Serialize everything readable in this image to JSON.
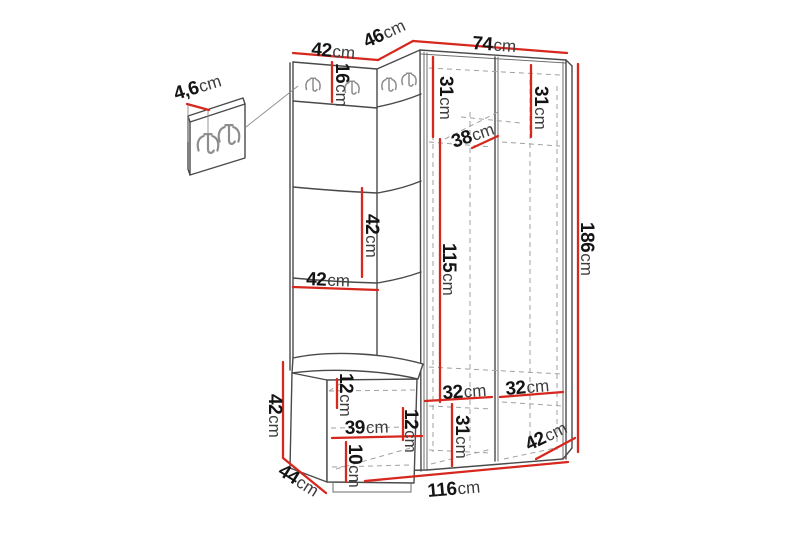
{
  "diagram": {
    "description": "Dimension diagram of a corner hallway furniture set: wall panel with coat hooks, corner section, two-door wardrobe and seat bench, plus a detail view of the hook panel",
    "unit": "cm",
    "colors": {
      "background": "#ffffff",
      "outline": "#4a4a4a",
      "hidden_lines": "#a0a0a0",
      "dimension_line": "#d7281f",
      "number_text": "#141414",
      "unit_text": "#3c3c3c"
    },
    "labels": [
      {
        "id": "panel-width-top",
        "value": "42",
        "unit": "cm"
      },
      {
        "id": "corner-width-top",
        "value": "46",
        "unit": "cm"
      },
      {
        "id": "wardrobe-width-top",
        "value": "74",
        "unit": "cm"
      },
      {
        "id": "hook-strip-height",
        "value": "16",
        "unit": "cm"
      },
      {
        "id": "wall-panel-depth",
        "value": "4,6",
        "unit": "cm"
      },
      {
        "id": "upper-left-compartment-height",
        "value": "31",
        "unit": "cm"
      },
      {
        "id": "upper-right-compartment-height",
        "value": "31",
        "unit": "cm"
      },
      {
        "id": "upper-shelf-depth",
        "value": "38",
        "unit": "cm"
      },
      {
        "id": "panel-middle-section-height",
        "value": "42",
        "unit": "cm"
      },
      {
        "id": "panel-middle-width",
        "value": "42",
        "unit": "cm"
      },
      {
        "id": "hanging-space-height",
        "value": "115",
        "unit": "cm"
      },
      {
        "id": "total-height",
        "value": "186",
        "unit": "cm"
      },
      {
        "id": "bench-height",
        "value": "42",
        "unit": "cm"
      },
      {
        "id": "bench-top-section-height",
        "value": "12",
        "unit": "cm"
      },
      {
        "id": "bench-opening-width",
        "value": "39",
        "unit": "cm"
      },
      {
        "id": "corner-inner-height",
        "value": "12",
        "unit": "cm"
      },
      {
        "id": "bench-shelf-height",
        "value": "10",
        "unit": "cm"
      },
      {
        "id": "bench-depth",
        "value": "44",
        "unit": "cm"
      },
      {
        "id": "lower-left-compartment-width",
        "value": "32",
        "unit": "cm"
      },
      {
        "id": "lower-right-compartment-width",
        "value": "32",
        "unit": "cm"
      },
      {
        "id": "lower-compartment-height",
        "value": "31",
        "unit": "cm"
      },
      {
        "id": "wardrobe-depth",
        "value": "42",
        "unit": "cm"
      },
      {
        "id": "total-bottom-width",
        "value": "116",
        "unit": "cm"
      }
    ]
  }
}
